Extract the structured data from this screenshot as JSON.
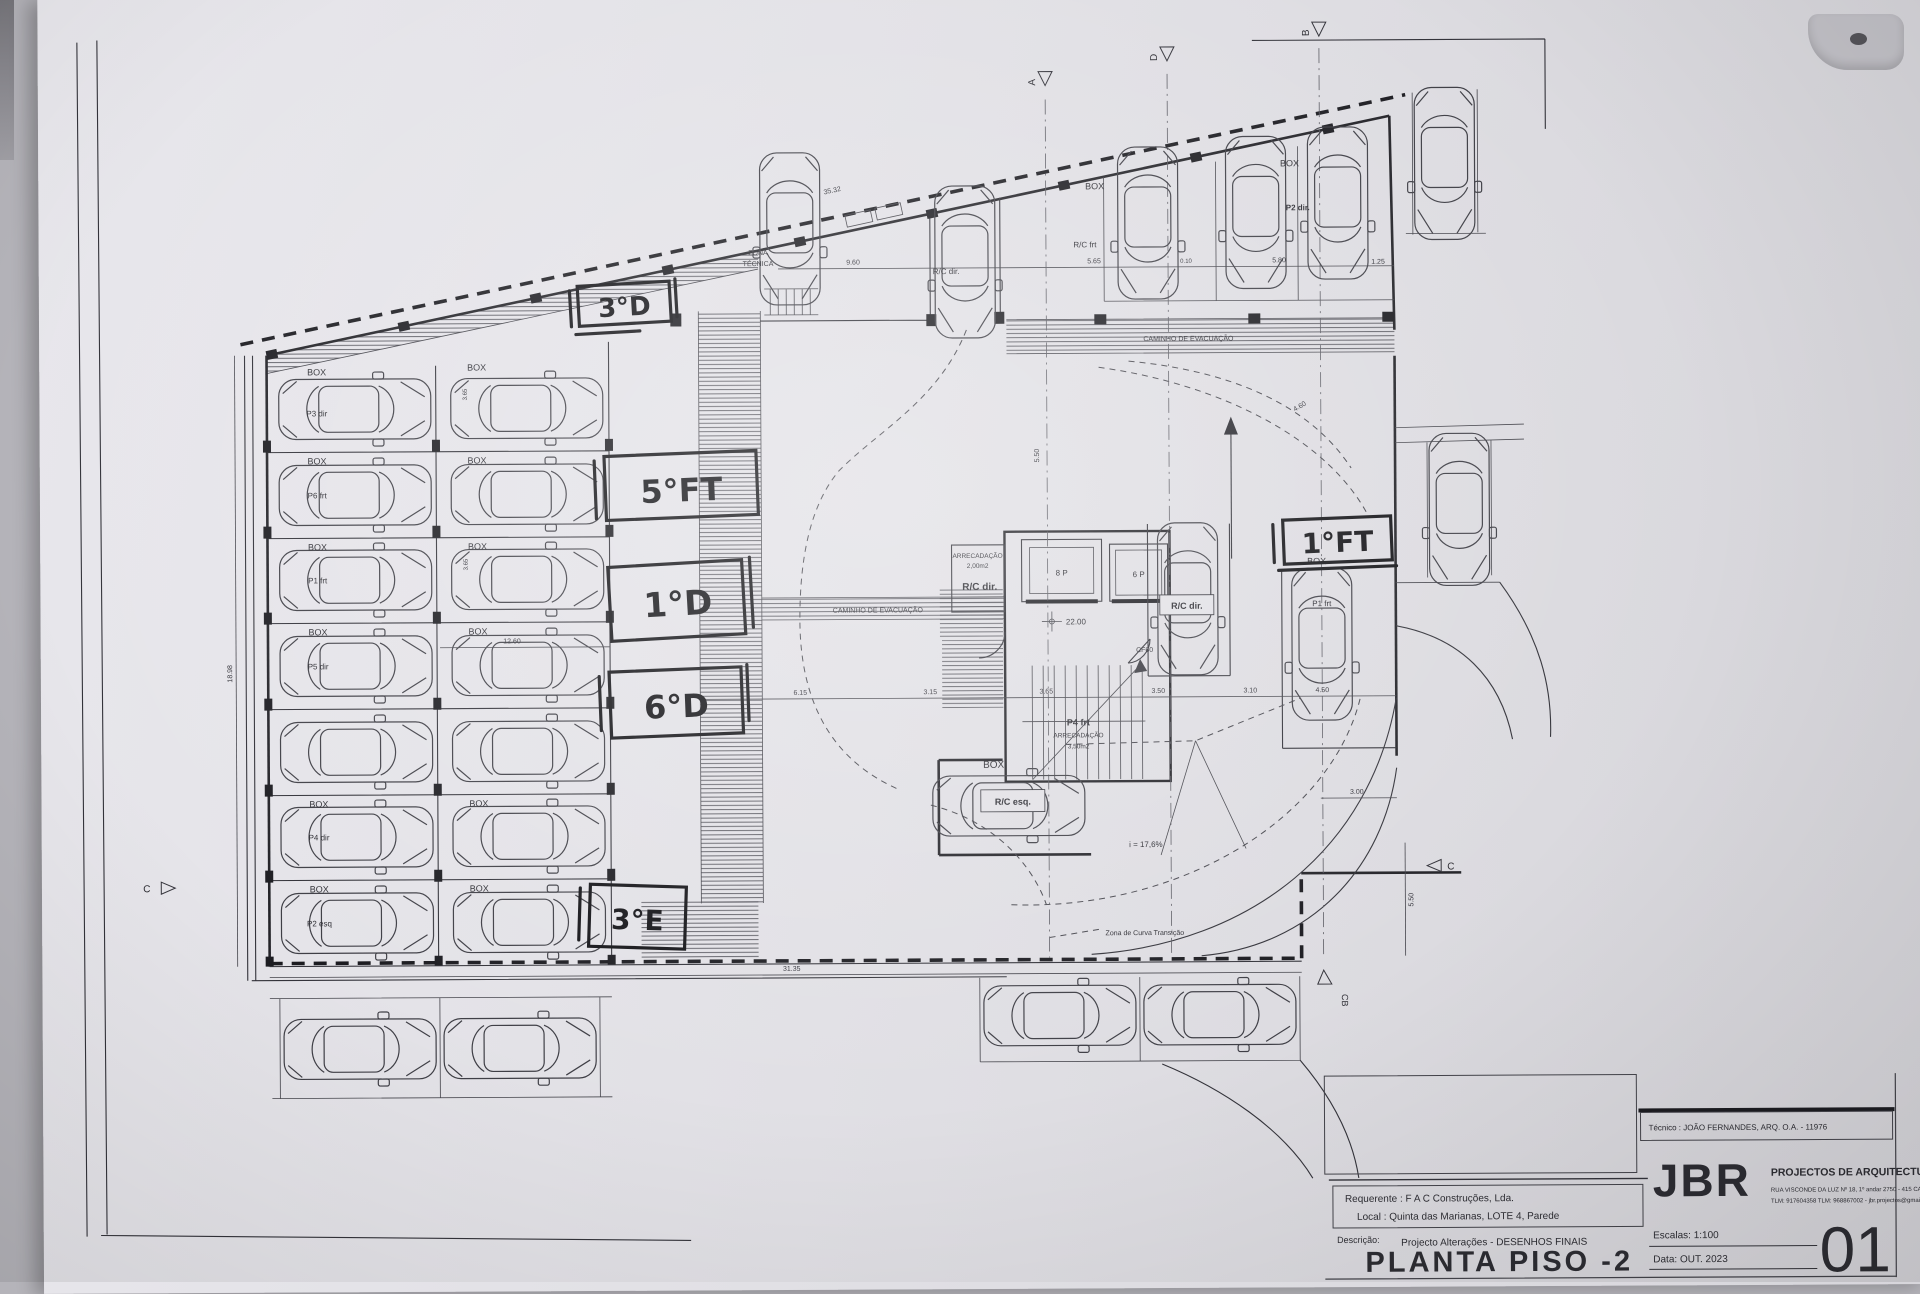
{
  "photo": {
    "backdrop": "#b5b4ba",
    "paper": "#e0dfe5",
    "ink": "#2c2c32",
    "marker_ink": "#141418"
  },
  "titleblock": {
    "tecnico": "Técnico : JOÃO FERNANDES, ARQ.   O.A. - 11976",
    "requerente": "Requerente : F A C  Construções, Lda.",
    "local": "Local : Quinta das Marianas, LOTE 4, Parede",
    "descricao_label": "Descrição:",
    "descricao": "Projecto Alterações - DESENHOS FINAIS",
    "title": "PLANTA PISO -2",
    "logo": "JBR",
    "logo_sub": "PROJECTOS DE ARQUITECTURA",
    "address1": "RUA VISCONDE DA LUZ Nº 18, 1º andar  2750 - 415  CASCAIS",
    "address2": "TLM: 917604358  TLM: 968867002 - jbr.projectos@gmail.com",
    "escala": "Escalas:  1:100",
    "data": "Data: OUT.  2023",
    "sheet_number": "01"
  },
  "handwritten": {
    "h3d": "3°D",
    "h5ft": "5°FT",
    "h1d": "1°D",
    "h6d": "6°D",
    "h3e": "3°E",
    "h1ft": "1°FT"
  },
  "labels": {
    "box": "BOX",
    "zona1": "ZONA",
    "zona2": "TÉCNICA",
    "cam_evac": "CAMINHO DE EVACUAÇÃO",
    "rc_frt": "R/C frt",
    "p2_dir": "P2 dir.",
    "rc_dir": "R/C dir.",
    "rc_esq": "R/C esq.",
    "p1_frt": "P1 frt",
    "p4_frt": "P4 frt",
    "arrec": "ARRECADAÇÃO",
    "area2": "2,00m2",
    "area35": "3,50m2",
    "lift8": "8 P",
    "lift6": "6 P",
    "level": "22.00",
    "cf60": "CF60",
    "slope": "i = 17,6%",
    "curve_zone": "Zona de Curva Transição",
    "p3_dir": "P3 dir",
    "p6_frt": "P6 frt",
    "p1_frt_row": "P1 frt",
    "p5_dir": "P5 dir",
    "p4_dir": "P4 dir",
    "p2_esq": "P2 esq",
    "mk_a": "A",
    "mk_b": "B",
    "mk_c": "C",
    "mk_d": "D",
    "mk_cb": "CB"
  },
  "dims": {
    "top": "35.32",
    "d960": "9.60",
    "d565": "5.65",
    "d580": "5.80",
    "d125": "1.25",
    "d010": "0.10",
    "d615": "6.15",
    "d315": "3.15",
    "d365": "3.65",
    "d350": "3.50",
    "d310": "3.10",
    "d450": "4.50",
    "d1260": "12.60",
    "d3135": "31.35",
    "d300": "3.00",
    "d1898": "18.98",
    "d550": "5.50",
    "d460": "4.60"
  }
}
